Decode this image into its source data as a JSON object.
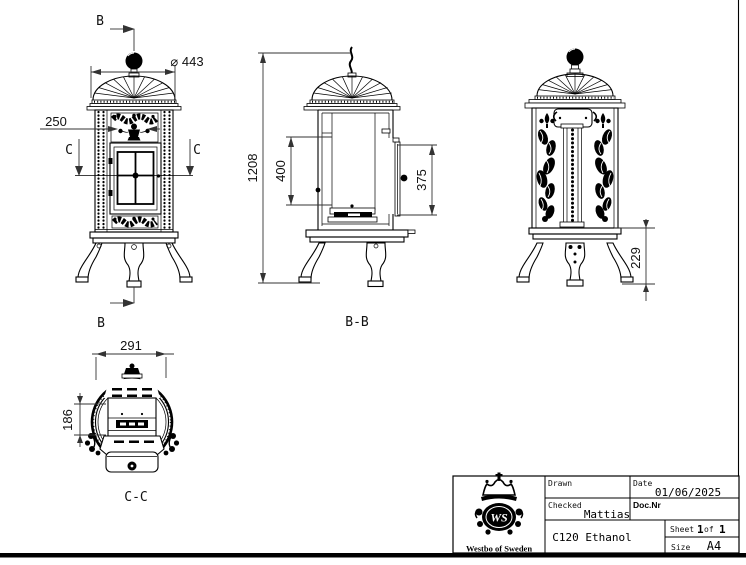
{
  "drawing": {
    "front": {
      "marker_top": "B",
      "marker_bottom": "B",
      "section_left": "C",
      "section_right": "C",
      "dim_diameter": "⌀ 443",
      "dim_ornament": "250"
    },
    "section_b": {
      "label": "B-B",
      "dim_height": "1208",
      "dim_opening": "400",
      "dim_door": "375"
    },
    "side": {
      "dim_leg": "229"
    },
    "section_c": {
      "label": "C-C",
      "dim_width": "291",
      "dim_depth": "186"
    }
  },
  "title_block": {
    "drawn_label": "Drawn",
    "date_label": "Date",
    "date_value": "01/06/2025",
    "checked_label": "Checked",
    "checked_value": "Mattias",
    "docnr_label": "Doc.Nr",
    "product_title": "C120 Ethanol",
    "sheet_label": "Sheet",
    "sheet_num": "1",
    "sheet_of": "of",
    "sheet_total": "1",
    "size_label": "Size",
    "size_value": "A4",
    "company": "Westbo of Sweden",
    "monogram": "WS"
  },
  "colors": {
    "line": "#000000",
    "background": "#ffffff",
    "dim_text": "#111111"
  }
}
